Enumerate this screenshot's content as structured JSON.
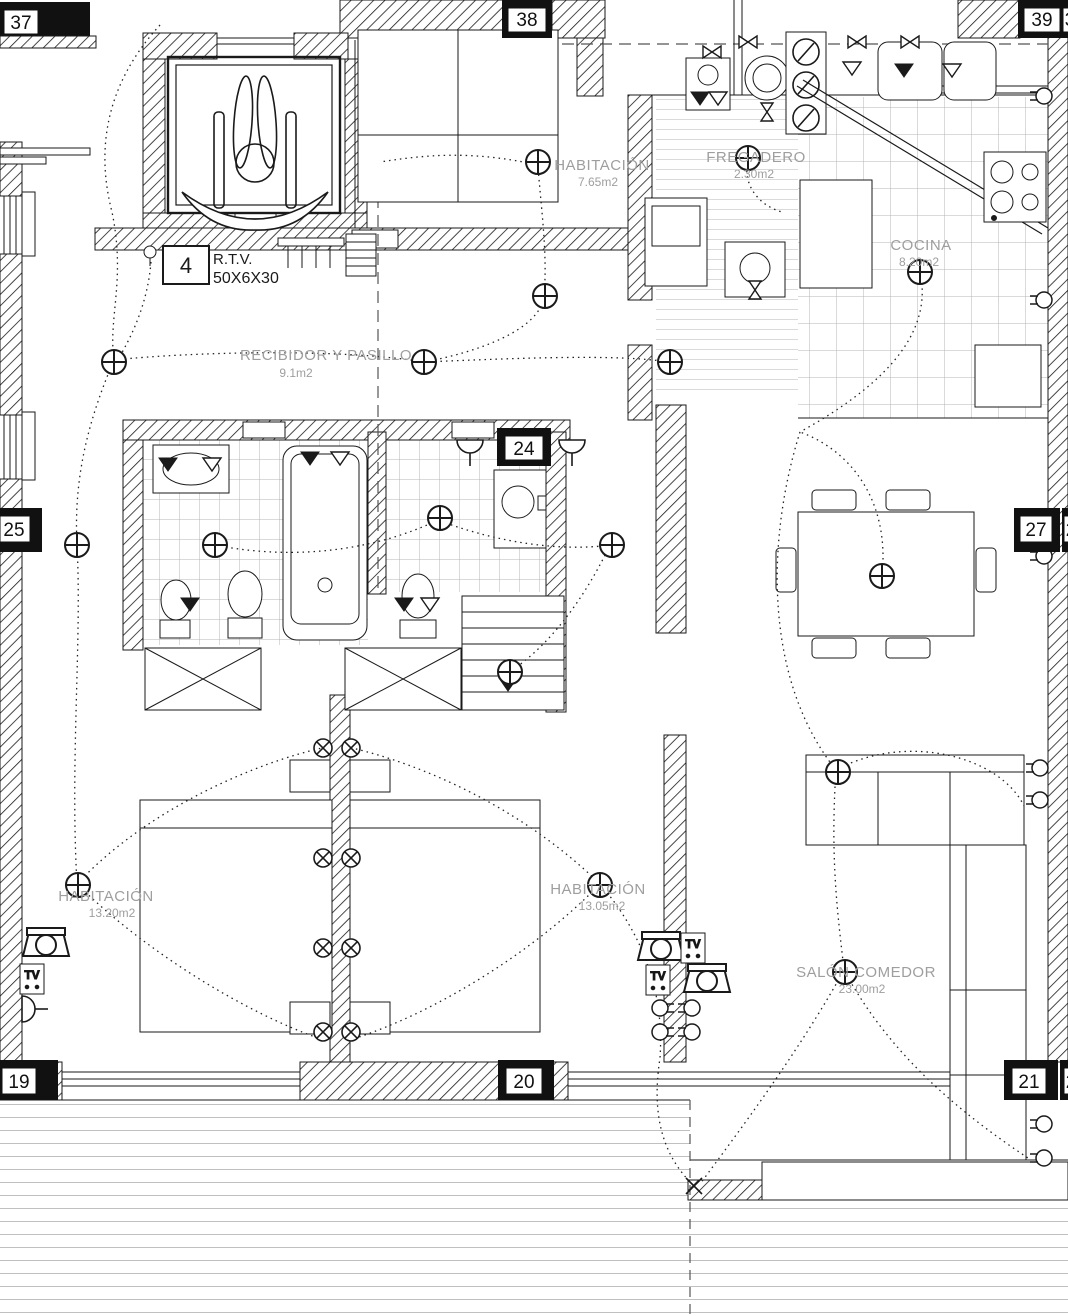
{
  "drawing": {
    "kind": "electrical-and-plumbing floor plan",
    "colors": {
      "ink": "#1a1a1a",
      "paper": "#ffffff",
      "label_gray": "#9e9e9e",
      "tile_gray": "#b5b5b5",
      "deck_gray": "#9a9a9a"
    }
  },
  "rooms": {
    "hab_top": {
      "name": "HABITACIÓN",
      "area": "7.65m2"
    },
    "fregadero": {
      "name": "FREGADERO",
      "area": "2.30m2"
    },
    "cocina": {
      "name": "COCINA",
      "area": "8.20m2"
    },
    "recibidor": {
      "name": "RECIBIDOR Y PASILLO",
      "area": "9.1m2"
    },
    "hab_left": {
      "name": "HABITACIÓN",
      "area": "13.20m2"
    },
    "hab_mid": {
      "name": "HABITACIÓN",
      "area": "13.05m2"
    },
    "salon": {
      "name": "SALÓN COMEDOR",
      "area": "23.00m2"
    }
  },
  "markers": {
    "m37": {
      "label": "37"
    },
    "m38": {
      "label": "38"
    },
    "m39": {
      "label": "39"
    },
    "m39b": {
      "label": "3"
    },
    "m25": {
      "label": "25"
    },
    "m24": {
      "label": "24"
    },
    "m27": {
      "label": "27"
    },
    "m27b": {
      "label": "2"
    },
    "m19": {
      "label": "19"
    },
    "m20": {
      "label": "20"
    },
    "m21": {
      "label": "21"
    },
    "m21b": {
      "label": "2"
    },
    "m4": {
      "label": "4"
    }
  },
  "annotations": {
    "rtv_line1": "R.T.V.",
    "rtv_line2": "50X6X30",
    "tv": "TV"
  },
  "legend_symbols": [
    "ceiling-light-icon",
    "wall-lamp-icon",
    "socket-icon",
    "tv-outlet-icon",
    "phone-outlet-icon",
    "valve-icon",
    "meter-icon",
    "wheelchair-accessibility-icon"
  ]
}
